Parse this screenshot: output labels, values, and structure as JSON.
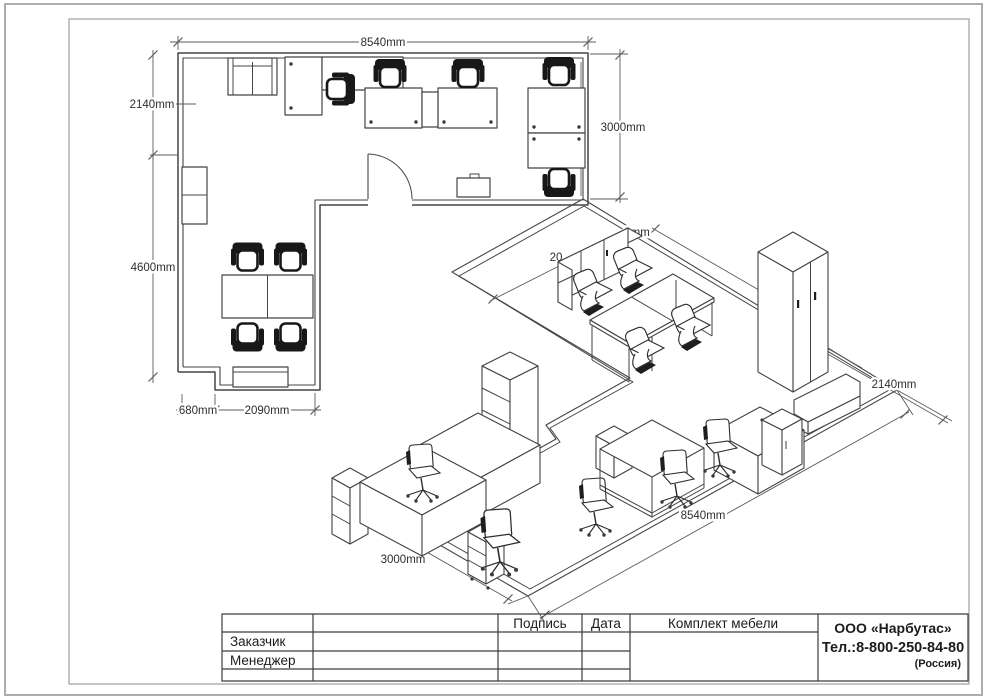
{
  "colors": {
    "line": "#454545",
    "dimension": "#5b5b5b",
    "chair_fill": "#181818",
    "page_border": "#abaeb0",
    "inner_frame": "#9aa0a3",
    "text": "#1c1c1c",
    "background": "#ffffff"
  },
  "floor_plan": {
    "dimensions": {
      "top": "8540mm",
      "left_upper": "2140mm",
      "left_lower": "4600mm",
      "right": "3000mm",
      "bottom_small": "680mm",
      "bottom": "2090mm"
    }
  },
  "iso_view": {
    "dimensions": {
      "left": "3000mm",
      "bottom": "8540mm",
      "right": "2140mm",
      "partial_back_left": "20",
      "partial_back_right": "0mm"
    }
  },
  "title_block": {
    "col_signature": "Подпись",
    "col_date": "Дата",
    "col_set": "Комплект мебели",
    "row_customer": "Заказчик",
    "row_manager": "Менеджер",
    "company": {
      "name": "ООО «Нарбутас»",
      "phone": "Тел.:8-800-250-84-80",
      "country": "(Россия)"
    }
  }
}
